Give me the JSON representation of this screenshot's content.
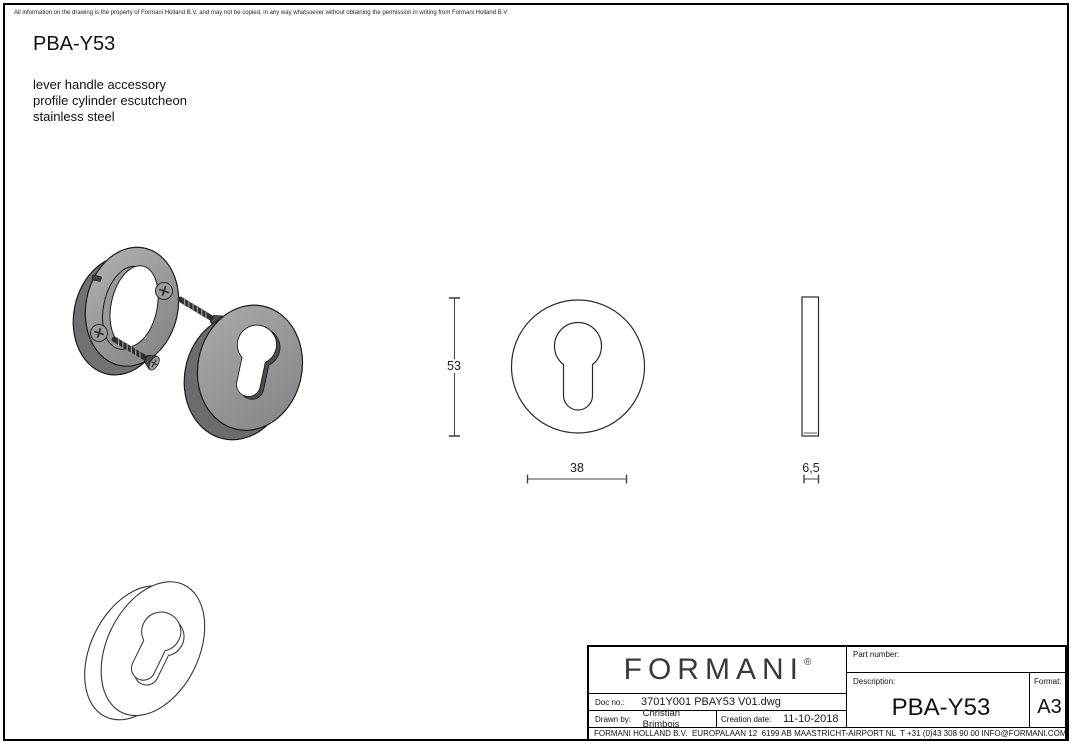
{
  "page": {
    "disclaimer": "All information on the drawing is the property of Formani Holland B.V. and may not be copied, in any way whatsoever without obtaining the permission in writing from Formani Holland B.V",
    "title": "PBA-Y53",
    "description_lines": [
      "lever handle accessory",
      "profile cylinder escutcheon",
      "stainless steel"
    ]
  },
  "drawing": {
    "views": [
      "exploded-isometric-view",
      "front-view",
      "side-view",
      "wireframe-isometric-view"
    ],
    "dimensions": {
      "height": "53",
      "width": "38",
      "thickness": "6,5"
    },
    "colors": {
      "steel_face": "#8f9194",
      "steel_rim": "#6f7173",
      "line": "#2b2b2b"
    }
  },
  "title_block": {
    "logo": "FORMANI",
    "logo_mark": "®",
    "doc_no_label": "Doc no.:",
    "doc_no": "3701Y001 PBAY53 V01.dwg",
    "drawn_by_label": "Drawn by:",
    "drawn_by": "Christian Brimbois",
    "creation_date_label": "Creation date:",
    "creation_date": "11-10-2018",
    "part_number_label": "Part number:",
    "part_number": "",
    "description_label": "Description:",
    "description": "PBA-Y53",
    "format_label": "Format:",
    "format": "A3",
    "footer": "FORMANI HOLLAND B.V.  EUROPALAAN 12  6199 AB MAASTRICHT-AIRPORT NL  T +31 (0)43 308 90 00 INFO@FORMANI.COM FORMANI.COM"
  }
}
